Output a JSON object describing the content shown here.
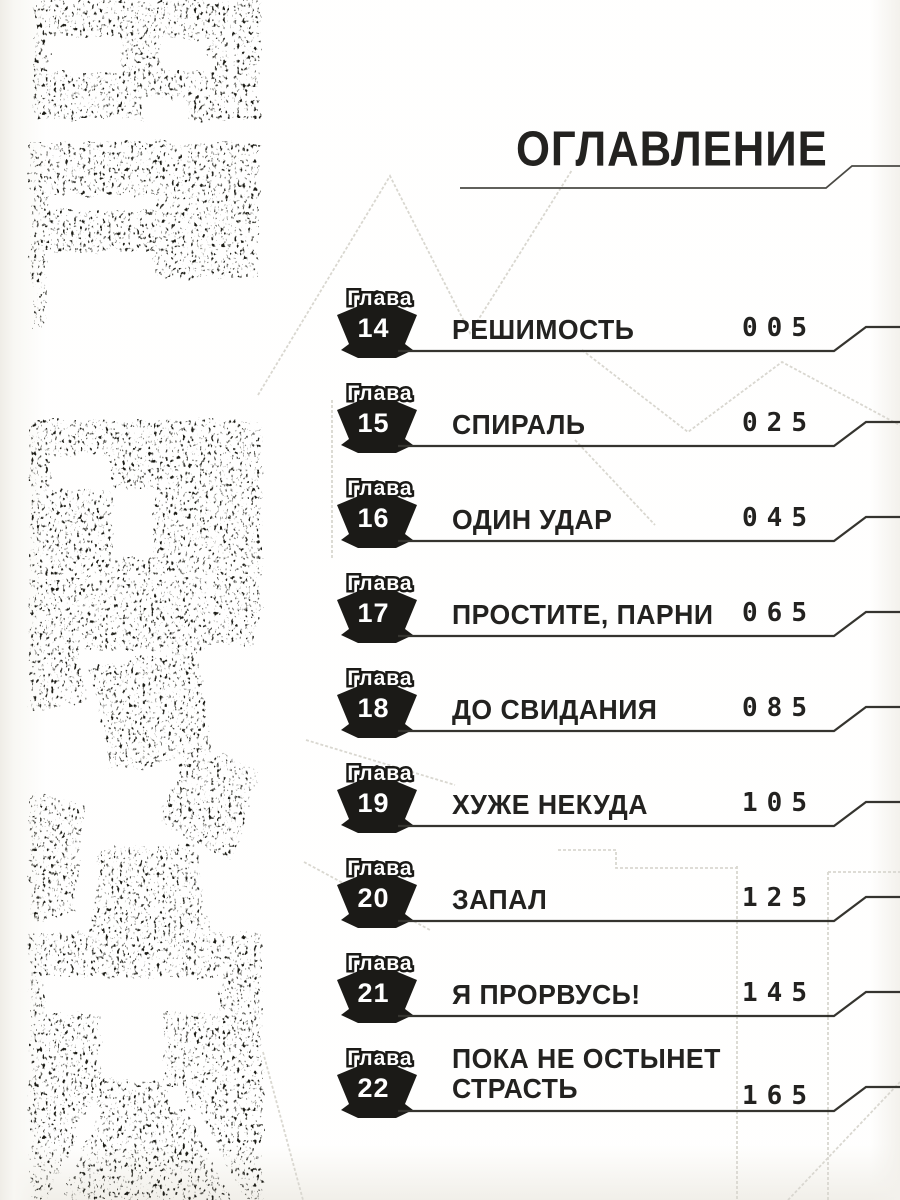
{
  "labels": {
    "header": "ОГЛАВЛЕНИЕ",
    "chapter_word": "Глава"
  },
  "chapters": [
    {
      "number": "14",
      "title": "РЕШИМОСТЬ",
      "page": "005"
    },
    {
      "number": "15",
      "title": "СПИРАЛЬ",
      "page": "025"
    },
    {
      "number": "16",
      "title": "ОДИН УДАР",
      "page": "045"
    },
    {
      "number": "17",
      "title": "ПРОСТИТЕ, ПАРНИ",
      "page": "065"
    },
    {
      "number": "18",
      "title": "ДО СВИДАНИЯ",
      "page": "085"
    },
    {
      "number": "19",
      "title": "ХУЖЕ НЕКУДА",
      "page": "105"
    },
    {
      "number": "20",
      "title": "ЗАПАЛ",
      "page": "125"
    },
    {
      "number": "21",
      "title": "Я ПРОРВУСЬ!",
      "page": "145"
    },
    {
      "number": "22",
      "title": "ПОКА НЕ ОСТЫНЕТ СТРАСТЬ",
      "title_line1": "ПОКА НЕ ОСТЫНЕТ",
      "title_line2": "СТРАСТЬ",
      "page": "165"
    }
  ],
  "artwork": {
    "description": "distressed black vertical manga-logo lettering with soccer-ball style pentagon segment",
    "ink_color": "#1b1a17"
  },
  "colors": {
    "paper": "#fcfbf8",
    "text": "#232220",
    "rule_line": "#35342f",
    "watermark": "#d9d7d0"
  }
}
